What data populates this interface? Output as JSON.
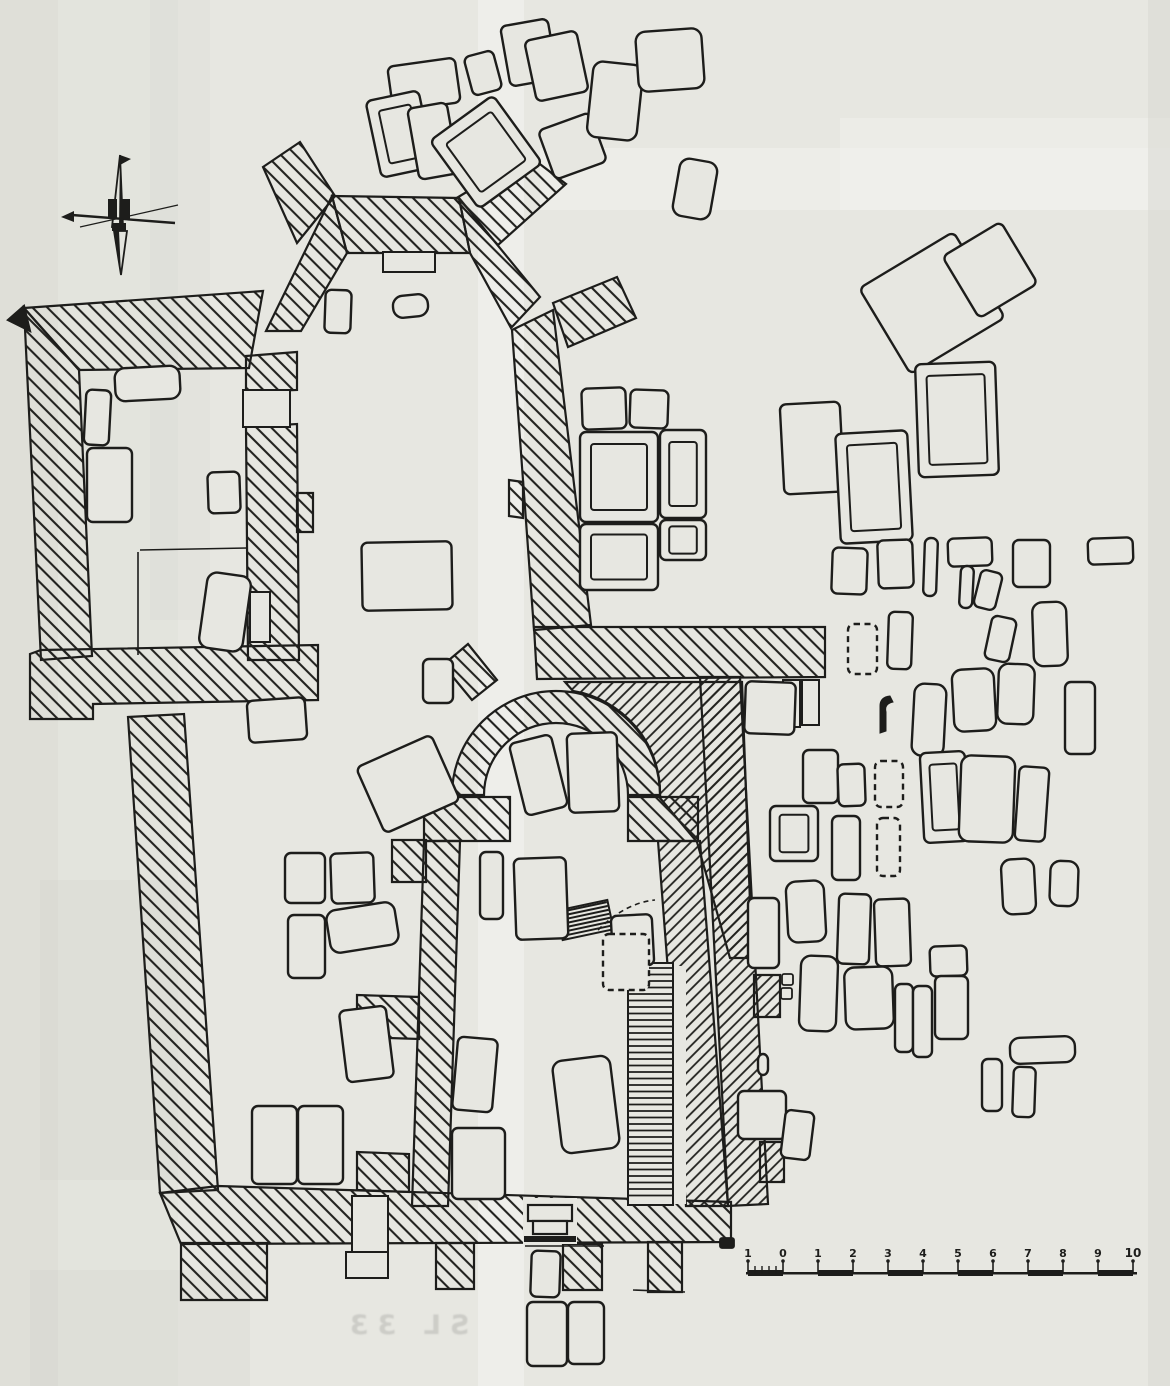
{
  "page": {
    "kind": "scanned archaeological excavation plan (church with graveyard)",
    "paper_color": "#e7e7e1",
    "ink_color": "#1d1d1b"
  },
  "caption": {
    "text": "SL 33"
  },
  "scale_bar": {
    "unit_labels": [
      "1",
      "0",
      "1",
      "2",
      "3",
      "4",
      "5",
      "6",
      "7",
      "8",
      "9",
      "10"
    ],
    "x_start": 748,
    "y_base": 1272,
    "step": 35
  },
  "paper": {
    "bands": [
      {
        "x": 0,
        "y": 0,
        "w": 1170,
        "h": 1386,
        "c": "#e7e7e1",
        "o": 1
      },
      {
        "x": 0,
        "y": 0,
        "w": 58,
        "h": 1386,
        "c": "#d8d8d2",
        "o": 0.55
      },
      {
        "x": 58,
        "y": 0,
        "w": 120,
        "h": 1386,
        "c": "#dedfd8",
        "o": 0.35
      },
      {
        "x": 478,
        "y": 0,
        "w": 46,
        "h": 1386,
        "c": "#f4f4f0",
        "o": 0.6
      },
      {
        "x": 540,
        "y": 148,
        "w": 630,
        "h": 62,
        "c": "#f3f3ef",
        "o": 0.55
      },
      {
        "x": 840,
        "y": 118,
        "w": 330,
        "h": 92,
        "c": "#f1f1ed",
        "o": 0.5
      },
      {
        "x": 1148,
        "y": 0,
        "w": 22,
        "h": 1386,
        "c": "#d7d7d1",
        "o": 0.5
      },
      {
        "x": 40,
        "y": 880,
        "w": 150,
        "h": 300,
        "c": "#c9c9c3",
        "o": 0.16
      },
      {
        "x": 30,
        "y": 1270,
        "w": 220,
        "h": 116,
        "c": "#c9c9c3",
        "o": 0.18
      },
      {
        "x": 150,
        "y": 0,
        "w": 60,
        "h": 620,
        "c": "#c9c9c3",
        "o": 0.12
      }
    ]
  },
  "plan": {
    "walls": [
      {
        "d": "M24,308 L263,291 L249,368 L79,370 Z"
      },
      {
        "d": "M24,308 L79,370 L92,656 L41,660 Z"
      },
      {
        "d": "M41,650 L318,645 L318,700 L93,704 L93,719 L30,719 L30,654 Z"
      },
      {
        "d": "M246,356 L297,352 L297,390 L246,392 Z"
      },
      {
        "d": "M246,427 L297,424 L299,660 L248,660 Z"
      },
      {
        "d": "M297,493 L313,493 L313,532 L297,532 Z"
      },
      {
        "d": "M332,196 L459,198 L470,253 L347,253 Z"
      },
      {
        "d": "M332,196 L347,253 L301,331 L266,331 Z"
      },
      {
        "d": "M459,198 L540,297 L511,328 L470,253 Z"
      },
      {
        "d": "M263,167 L300,142 L335,196 L297,243 Z"
      },
      {
        "d": "M455,199 L528,155 L566,184 L498,245 Z"
      },
      {
        "d": "M553,303 L617,277 L636,318 L568,347 Z"
      },
      {
        "d": "M512,330 L553,310 L591,625 L534,630 Z"
      },
      {
        "d": "M509,480 L523,482 L523,518 L509,516 Z"
      },
      {
        "d": "M534,627 L825,627 L825,677 L537,679 Z"
      },
      {
        "d": "M565,682 L742,682 L752,958 L730,958 L697,842 L660,798 A104,104 0 0 0 573,691 Z",
        "h": "b"
      },
      {
        "d": "M452,795 A104,104 0 0 1 660,795 L628,795 A72,72 0 0 0 484,795 Z"
      },
      {
        "d": "M424,797 L510,797 L510,841 L424,841 Z"
      },
      {
        "d": "M628,797 L698,797 L698,841 L628,841 Z"
      },
      {
        "d": "M424,841 L460,841 L448,1206 L412,1206 Z"
      },
      {
        "d": "M658,841 L700,841 L728,1206 L686,1206 Z",
        "h": "b"
      },
      {
        "d": "M392,840 L426,840 L426,882 L392,882 Z"
      },
      {
        "d": "M357,995 L419,997 L419,1039 L357,1037 Z"
      },
      {
        "d": "M357,1152 L409,1154 L409,1192 L357,1190 Z"
      },
      {
        "d": "M472,700 L443,665 L468,644 L497,680 Z"
      },
      {
        "d": "M128,717 L184,714 L218,1190 L160,1193 Z"
      },
      {
        "d": "M160,1193 L218,1186 L731,1202 L731,1242 L181,1244 Z"
      },
      {
        "d": "M700,677 L740,677 L768,1204 L728,1206 Z",
        "h": "b"
      },
      {
        "d": "M754,975 L780,975 L780,1017 L754,1017 Z",
        "h": "b"
      },
      {
        "d": "M760,1142 L784,1142 L784,1182 L760,1182 Z",
        "h": "b"
      },
      {
        "d": "M181,1243 L267,1243 L267,1300 L181,1300 Z"
      },
      {
        "d": "M436,1243 L474,1243 L474,1289 L436,1289 Z"
      },
      {
        "d": "M563,1244 L602,1244 L602,1290 L563,1290 Z"
      },
      {
        "d": "M648,1242 L682,1242 L682,1292 L648,1292 Z"
      },
      {
        "d": "M24,306 L8,320 L30,331 Z",
        "solid": true
      }
    ],
    "niches": [
      {
        "x": 250,
        "y": 592,
        "w": 20,
        "h": 50
      },
      {
        "x": 383,
        "y": 252,
        "w": 52,
        "h": 20
      },
      {
        "x": 783,
        "y": 680,
        "w": 17,
        "h": 47
      },
      {
        "x": 802,
        "y": 680,
        "w": 17,
        "h": 45
      },
      {
        "x": 243,
        "y": 390,
        "w": 47,
        "h": 37
      },
      {
        "x": 352,
        "y": 1196,
        "w": 36,
        "h": 64
      },
      {
        "x": 346,
        "y": 1252,
        "w": 42,
        "h": 26
      }
    ],
    "entrance": {
      "eraser": {
        "x": 523,
        "y": 1198,
        "w": 54,
        "h": 46
      },
      "steps": [
        {
          "x": 528,
          "y": 1205,
          "w": 44,
          "h": 16
        },
        {
          "x": 533,
          "y": 1221,
          "w": 34,
          "h": 13
        }
      ],
      "threshold": {
        "x": 524,
        "y": 1236,
        "w": 52,
        "h": 6
      }
    },
    "stairs": {
      "x": 628,
      "y": 963,
      "w": 45,
      "h": 242,
      "step": 6.5,
      "head": {
        "cx": 585,
        "cy": 920,
        "w": 52,
        "h": 30,
        "rot": -12,
        "step": 4
      },
      "side_strip": {
        "x": 674,
        "y": 966,
        "w": 12,
        "h": 238
      }
    },
    "graves": [
      {
        "x": 390,
        "y": 62,
        "w": 68,
        "h": 45,
        "r": -8
      },
      {
        "x": 373,
        "y": 95,
        "w": 54,
        "h": 78,
        "r": -12,
        "s": "f"
      },
      {
        "x": 413,
        "y": 105,
        "w": 40,
        "h": 72,
        "r": -10
      },
      {
        "x": 447,
        "y": 110,
        "w": 78,
        "h": 84,
        "r": -36,
        "s": "f"
      },
      {
        "x": 468,
        "y": 53,
        "w": 30,
        "h": 40,
        "r": -15
      },
      {
        "x": 505,
        "y": 22,
        "w": 48,
        "h": 61,
        "r": -10
      },
      {
        "x": 530,
        "y": 35,
        "w": 53,
        "h": 62,
        "r": -12
      },
      {
        "x": 545,
        "y": 120,
        "w": 55,
        "h": 52,
        "r": -20
      },
      {
        "x": 590,
        "y": 63,
        "w": 50,
        "h": 76,
        "r": 6,
        "s": "i"
      },
      {
        "x": 637,
        "y": 30,
        "w": 66,
        "h": 60,
        "r": -4,
        "s": "i"
      },
      {
        "x": 676,
        "y": 160,
        "w": 38,
        "h": 58,
        "r": 10,
        "s": "i"
      },
      {
        "x": 877,
        "y": 253,
        "w": 110,
        "h": 100,
        "r": -31
      },
      {
        "x": 956,
        "y": 234,
        "w": 68,
        "h": 72,
        "r": -31
      },
      {
        "x": 917,
        "y": 363,
        "w": 80,
        "h": 113,
        "r": -2,
        "s": "f"
      },
      {
        "x": 782,
        "y": 403,
        "w": 60,
        "h": 90,
        "r": -3
      },
      {
        "x": 838,
        "y": 432,
        "w": 72,
        "h": 110,
        "r": -3,
        "s": "f"
      },
      {
        "x": 832,
        "y": 548,
        "w": 35,
        "h": 46,
        "r": 2
      },
      {
        "x": 878,
        "y": 540,
        "w": 35,
        "h": 48,
        "r": -2
      },
      {
        "x": 924,
        "y": 538,
        "w": 13,
        "h": 58,
        "r": 2
      },
      {
        "x": 948,
        "y": 538,
        "w": 44,
        "h": 28,
        "r": -2
      },
      {
        "x": 960,
        "y": 566,
        "w": 13,
        "h": 42,
        "r": 3
      },
      {
        "x": 977,
        "y": 571,
        "w": 22,
        "h": 38,
        "r": 14
      },
      {
        "x": 1013,
        "y": 540,
        "w": 37,
        "h": 47,
        "r": 0
      },
      {
        "x": 1088,
        "y": 538,
        "w": 45,
        "h": 26,
        "r": -2
      },
      {
        "x": 848,
        "y": 624,
        "w": 29,
        "h": 50,
        "r": 0,
        "s": "d"
      },
      {
        "x": 888,
        "y": 612,
        "w": 24,
        "h": 57,
        "r": 2
      },
      {
        "x": 988,
        "y": 617,
        "w": 25,
        "h": 44,
        "r": 12
      },
      {
        "x": 1033,
        "y": 602,
        "w": 34,
        "h": 64,
        "r": -2,
        "s": "i"
      },
      {
        "x": 913,
        "y": 684,
        "w": 32,
        "h": 72,
        "r": 3,
        "s": "i"
      },
      {
        "x": 953,
        "y": 669,
        "w": 42,
        "h": 62,
        "r": -3,
        "s": "i"
      },
      {
        "x": 998,
        "y": 664,
        "w": 36,
        "h": 60,
        "r": 2,
        "s": "i"
      },
      {
        "x": 1065,
        "y": 682,
        "w": 30,
        "h": 72,
        "r": 0
      },
      {
        "x": 745,
        "y": 682,
        "w": 50,
        "h": 52,
        "r": 2
      },
      {
        "x": 803,
        "y": 750,
        "w": 35,
        "h": 53,
        "r": 0
      },
      {
        "x": 838,
        "y": 764,
        "w": 27,
        "h": 42,
        "r": -2
      },
      {
        "x": 875,
        "y": 761,
        "w": 28,
        "h": 46,
        "r": 0,
        "s": "d"
      },
      {
        "x": 922,
        "y": 752,
        "w": 45,
        "h": 90,
        "r": -3,
        "s": "f"
      },
      {
        "x": 960,
        "y": 756,
        "w": 54,
        "h": 86,
        "r": 2,
        "s": "i"
      },
      {
        "x": 1017,
        "y": 767,
        "w": 30,
        "h": 74,
        "r": 4
      },
      {
        "x": 770,
        "y": 806,
        "w": 48,
        "h": 55,
        "r": 0,
        "s": "f"
      },
      {
        "x": 832,
        "y": 816,
        "w": 28,
        "h": 64,
        "r": 0
      },
      {
        "x": 877,
        "y": 818,
        "w": 23,
        "h": 58,
        "r": 0,
        "s": "d"
      },
      {
        "x": 748,
        "y": 898,
        "w": 31,
        "h": 70,
        "r": 0
      },
      {
        "x": 787,
        "y": 881,
        "w": 38,
        "h": 61,
        "r": -3,
        "s": "i"
      },
      {
        "x": 838,
        "y": 894,
        "w": 32,
        "h": 70,
        "r": 2
      },
      {
        "x": 875,
        "y": 899,
        "w": 35,
        "h": 67,
        "r": -2
      },
      {
        "x": 800,
        "y": 956,
        "w": 37,
        "h": 75,
        "r": 2,
        "s": "i"
      },
      {
        "x": 845,
        "y": 967,
        "w": 48,
        "h": 62,
        "r": -2,
        "s": "i"
      },
      {
        "x": 895,
        "y": 984,
        "w": 18,
        "h": 68,
        "r": 0
      },
      {
        "x": 913,
        "y": 986,
        "w": 19,
        "h": 71,
        "r": 0
      },
      {
        "x": 930,
        "y": 946,
        "w": 37,
        "h": 30,
        "r": -2
      },
      {
        "x": 935,
        "y": 976,
        "w": 33,
        "h": 63,
        "r": 0
      },
      {
        "x": 1002,
        "y": 859,
        "w": 33,
        "h": 55,
        "r": -3,
        "s": "i"
      },
      {
        "x": 1050,
        "y": 861,
        "w": 28,
        "h": 45,
        "r": 2,
        "s": "i"
      },
      {
        "x": 1010,
        "y": 1037,
        "w": 65,
        "h": 26,
        "r": -2,
        "s": "i"
      },
      {
        "x": 982,
        "y": 1059,
        "w": 20,
        "h": 52,
        "r": 0
      },
      {
        "x": 1013,
        "y": 1067,
        "w": 22,
        "h": 50,
        "r": 2
      },
      {
        "x": 758,
        "y": 1054,
        "w": 10,
        "h": 21,
        "r": 0
      },
      {
        "x": 738,
        "y": 1091,
        "w": 48,
        "h": 48,
        "r": 0
      },
      {
        "x": 783,
        "y": 1111,
        "w": 29,
        "h": 48,
        "r": 7
      },
      {
        "x": 115,
        "y": 367,
        "w": 65,
        "h": 33,
        "r": -3,
        "s": "i"
      },
      {
        "x": 85,
        "y": 390,
        "w": 25,
        "h": 55,
        "r": 3
      },
      {
        "x": 87,
        "y": 448,
        "w": 45,
        "h": 74,
        "r": 0
      },
      {
        "x": 208,
        "y": 472,
        "w": 32,
        "h": 41,
        "r": -2
      },
      {
        "x": 203,
        "y": 574,
        "w": 44,
        "h": 76,
        "r": 8,
        "s": "i"
      },
      {
        "x": 325,
        "y": 290,
        "w": 26,
        "h": 43,
        "r": 2
      },
      {
        "x": 393,
        "y": 295,
        "w": 35,
        "h": 22,
        "r": -6,
        "s": "i"
      },
      {
        "x": 362,
        "y": 542,
        "w": 90,
        "h": 68,
        "r": -1
      },
      {
        "x": 580,
        "y": 432,
        "w": 78,
        "h": 90,
        "r": 0,
        "s": "f"
      },
      {
        "x": 660,
        "y": 430,
        "w": 46,
        "h": 88,
        "r": 0,
        "s": "f"
      },
      {
        "x": 580,
        "y": 524,
        "w": 78,
        "h": 66,
        "r": 0,
        "s": "f"
      },
      {
        "x": 660,
        "y": 520,
        "w": 46,
        "h": 40,
        "r": 0,
        "s": "f"
      },
      {
        "x": 582,
        "y": 388,
        "w": 44,
        "h": 41,
        "r": -2
      },
      {
        "x": 630,
        "y": 390,
        "w": 38,
        "h": 38,
        "r": 2
      },
      {
        "x": 423,
        "y": 659,
        "w": 30,
        "h": 44,
        "r": 0
      },
      {
        "x": 248,
        "y": 699,
        "w": 58,
        "h": 42,
        "r": -4
      },
      {
        "x": 367,
        "y": 748,
        "w": 82,
        "h": 72,
        "r": -24
      },
      {
        "x": 285,
        "y": 853,
        "w": 40,
        "h": 50,
        "r": 0
      },
      {
        "x": 331,
        "y": 853,
        "w": 43,
        "h": 50,
        "r": -2
      },
      {
        "x": 288,
        "y": 915,
        "w": 37,
        "h": 63,
        "r": 0
      },
      {
        "x": 328,
        "y": 906,
        "w": 69,
        "h": 43,
        "r": -9,
        "s": "i"
      },
      {
        "x": 343,
        "y": 1008,
        "w": 47,
        "h": 72,
        "r": -7
      },
      {
        "x": 252,
        "y": 1106,
        "w": 45,
        "h": 78,
        "r": 0
      },
      {
        "x": 298,
        "y": 1106,
        "w": 45,
        "h": 78,
        "r": 0
      },
      {
        "x": 517,
        "y": 738,
        "w": 43,
        "h": 74,
        "r": -14
      },
      {
        "x": 568,
        "y": 733,
        "w": 50,
        "h": 79,
        "r": -2
      },
      {
        "x": 480,
        "y": 852,
        "w": 23,
        "h": 67,
        "r": 0
      },
      {
        "x": 515,
        "y": 858,
        "w": 52,
        "h": 81,
        "r": -2
      },
      {
        "x": 455,
        "y": 1038,
        "w": 40,
        "h": 73,
        "r": 5
      },
      {
        "x": 452,
        "y": 1128,
        "w": 53,
        "h": 71,
        "r": 0
      },
      {
        "x": 557,
        "y": 1058,
        "w": 58,
        "h": 93,
        "r": -7,
        "s": "i"
      },
      {
        "x": 612,
        "y": 915,
        "w": 41,
        "h": 51,
        "r": -3
      },
      {
        "x": 603,
        "y": 934,
        "w": 46,
        "h": 56,
        "r": 0,
        "s": "d"
      },
      {
        "x": 531,
        "y": 1251,
        "w": 29,
        "h": 46,
        "r": 2
      },
      {
        "x": 527,
        "y": 1302,
        "w": 40,
        "h": 64,
        "r": 0
      },
      {
        "x": 568,
        "y": 1302,
        "w": 36,
        "h": 62,
        "r": 0
      }
    ],
    "stones": [
      {
        "x": 862,
        "y": 1002,
        "w": 9,
        "h": 24,
        "f": 1
      },
      {
        "x": 873,
        "y": 1000,
        "w": 9,
        "h": 26,
        "f": 1
      },
      {
        "x": 884,
        "y": 1004,
        "w": 8,
        "h": 22,
        "f": 1
      },
      {
        "x": 782,
        "y": 974,
        "w": 11,
        "h": 11
      },
      {
        "x": 781,
        "y": 988,
        "w": 11,
        "h": 11
      },
      {
        "x": 720,
        "y": 1238,
        "w": 14,
        "h": 10,
        "f": 1
      },
      {
        "x": 1022,
        "y": 686,
        "w": 8,
        "h": 16,
        "f": 1,
        "r": 20
      },
      {
        "x": 963,
        "y": 705,
        "w": 24,
        "h": 7,
        "f": 1
      }
    ],
    "hook": {
      "d": "M880,733 L880,706 Q880,697 890,696 L893,702 Q884,704 886,712 L886,731 Z"
    },
    "lines": [
      {
        "x1": 140,
        "y1": 550,
        "x2": 247,
        "y2": 548
      },
      {
        "x1": 138,
        "y1": 552,
        "x2": 138,
        "y2": 655
      },
      {
        "x1": 525,
        "y1": 1246,
        "x2": 604,
        "y2": 1246
      },
      {
        "x1": 633,
        "y1": 1290,
        "x2": 685,
        "y2": 1292
      }
    ],
    "dashed_paths": [
      {
        "d": "M598,930 Q625,903 655,900"
      },
      {
        "d": "M968,760 L966,842"
      }
    ]
  }
}
